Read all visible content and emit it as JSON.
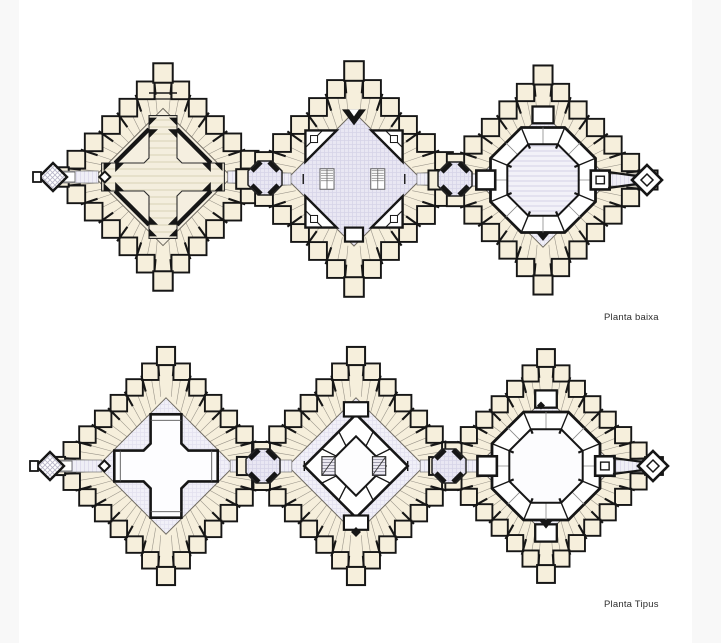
{
  "page": {
    "width": 721,
    "height": 643,
    "bg": "#ffffff",
    "margin_strip_color": "#f8f8f8"
  },
  "drawing": {
    "title_labels": [
      {
        "id": "planta-baixa",
        "text": "Planta baixa",
        "x": 604,
        "y": 312
      },
      {
        "id": "planta-tipus",
        "text": "Planta Tipus",
        "x": 604,
        "y": 599
      }
    ],
    "colors": {
      "wall": "#161616",
      "room_fill": "#f6efdc",
      "partition": "#9a958a",
      "ring_line": "#6f6a60",
      "hall_cream": "#f5efe0",
      "court_lavender": "#e9e7f3",
      "lavender_line": "#d7d4e8",
      "lavender_pale": "#f1f0f8",
      "lavender_pale_line": "#e2e0ef",
      "stripe_cream_bg": "#f4eede",
      "stripe_cream_line": "#e3dcc6",
      "stripe_lavender_bg": "#f2f1f8",
      "stripe_lavender_line": "#dedcec",
      "corridor_bg": "#efeef6",
      "corridor_line": "#dbd8ea",
      "corridor_edge": "#777777",
      "crosshatch_line": "#b7b4c8",
      "stair_bg": "#eceaf2",
      "stair_line": "#8f8da0",
      "white": "#ffffff"
    },
    "rows": [
      {
        "name": "planta-baixa-row",
        "connectors": [
          {
            "x": 265,
            "y": 178,
            "r": 17
          },
          {
            "x": 455,
            "y": 179,
            "r": 17
          }
        ],
        "plans": [
          {
            "name": "block-west-ground",
            "cx": 163,
            "cy": 177,
            "r": 104,
            "type": "cross-hall",
            "teeth": 5,
            "tooth": 0.17,
            "rin": 0.66,
            "base": "cream",
            "features": {
              "left_annex": true,
              "marker_diamond": [
                -0.56,
                0.0
              ],
              "top_bars": true
            }
          },
          {
            "name": "block-center-ground",
            "cx": 354,
            "cy": 179,
            "r": 108,
            "type": "stair-core",
            "teeth": 5,
            "tooth": 0.165,
            "rin": 0.62,
            "base": "grid",
            "features": {
              "v_arrow": true,
              "south_room": true
            }
          },
          {
            "name": "block-east-ground",
            "cx": 543,
            "cy": 180,
            "r": 105,
            "type": "octagon-court",
            "teeth": 5,
            "tooth": 0.165,
            "rin": 0.64,
            "base": "gridPale",
            "features": {
              "right_annex": true,
              "hatched_center": true,
              "north_rect": true,
              "south_arrow": true
            }
          }
        ]
      },
      {
        "name": "planta-tipus-row",
        "connectors": [
          {
            "x": 263,
            "y": 466,
            "r": 17
          },
          {
            "x": 449,
            "y": 466,
            "r": 17
          }
        ],
        "plans": [
          {
            "name": "block-west-typical",
            "cx": 166,
            "cy": 466,
            "r": 110,
            "type": "cross-court",
            "teeth": 6,
            "tooth": 0.15,
            "rin": 0.62,
            "base": "gridPale",
            "features": {
              "left_annex": true,
              "marker_diamond": [
                -0.56,
                0.0
              ]
            }
          },
          {
            "name": "block-center-typical",
            "cx": 356,
            "cy": 466,
            "r": 110,
            "type": "diamond-core",
            "teeth": 6,
            "tooth": 0.15,
            "rin": 0.62,
            "base": "gridPale",
            "features": {
              "south_diamond": true
            }
          },
          {
            "name": "block-east-typical",
            "cx": 546,
            "cy": 466,
            "r": 108,
            "type": "octagon-court",
            "teeth": 6,
            "tooth": 0.15,
            "rin": 0.64,
            "base": "gridPale",
            "features": {
              "right_annex": true,
              "north_rect": true,
              "south_rect": true,
              "north_diamond": true,
              "south_arrow": true
            }
          }
        ]
      }
    ]
  }
}
